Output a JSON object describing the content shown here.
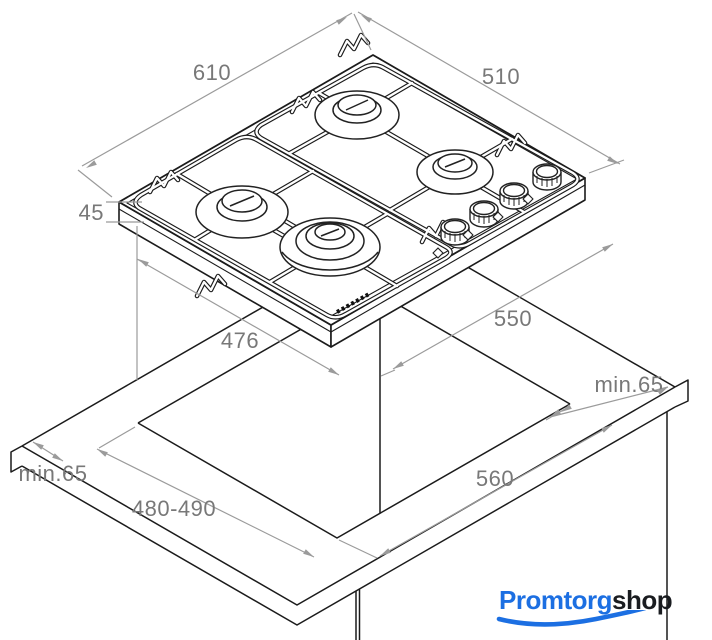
{
  "diagram": {
    "type": "isometric installation drawing",
    "subject": "built-in 4-burner gas hob with worktop cutout",
    "dims": {
      "hob_width": "610",
      "hob_depth": "510",
      "hob_height": "45",
      "body_width": "476",
      "cutout_side": "550",
      "cutout_front": "560",
      "cutout_depth": "480-490",
      "clearance_right": "min.65",
      "clearance_left": "min.65"
    },
    "colors": {
      "line": "#1b1b1b",
      "dimension_line": "#9b9b9b",
      "dimension_text": "#787878"
    }
  },
  "logo": {
    "blue_text": "Promtorg",
    "dark_text": "shop",
    "blue": "#1c6fe2",
    "dark": "#1a1c20"
  }
}
